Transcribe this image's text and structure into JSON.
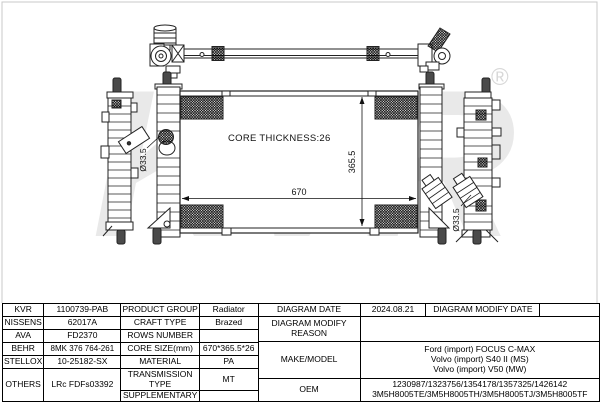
{
  "watermark": {
    "text": "KVR",
    "registered": "®",
    "color": "#e9e9e9"
  },
  "diagram": {
    "core_thickness_label": "CORE THICKNESS:26",
    "dim_width": "670",
    "dim_height": "365.5",
    "pipe_diameter_left": "Ø33.5",
    "pipe_diameter_right": "Ø33.5"
  },
  "table": {
    "brands": [
      {
        "brand": "KVR",
        "number": "1100739-PAB"
      },
      {
        "brand": "NISSENS",
        "number": "62017A"
      },
      {
        "brand": "AVA",
        "number": "FD2370"
      },
      {
        "brand": "BEHR",
        "number": "8MK 376 764-261"
      },
      {
        "brand": "STELLOX",
        "number": "10-25182-SX"
      },
      {
        "brand": "OTHERS",
        "number": "LRc FDFs03392"
      }
    ],
    "specs": [
      {
        "label": "PRODUCT GROUP",
        "value": "Radiator"
      },
      {
        "label": "CRAFT TYPE",
        "value": "Brazed"
      },
      {
        "label": "ROWS NUMBER",
        "value": ""
      },
      {
        "label": "CORE SIZE(mm)",
        "value": "670*365.5*26"
      },
      {
        "label": "MATERIAL",
        "value": "PA"
      },
      {
        "label": "TRANSMISSION TYPE",
        "value": "MT"
      },
      {
        "label": "SUPPLEMENTARY",
        "value": ""
      }
    ],
    "info": {
      "diagram_date_label": "DIAGRAM DATE",
      "diagram_date": "2024.08.21",
      "diagram_modify_date_label": "DIAGRAM MODIFY DATE",
      "diagram_modify_date": "",
      "diagram_modify_reason_label": "DIAGRAM MODIFY REASON",
      "diagram_modify_reason": "",
      "make_model_label": "MAKE/MODEL",
      "make_model": [
        "Ford (import) FOCUS C-MAX",
        "Volvo (import) S40 II (MS)",
        "Volvo (import) V50 (MW)"
      ],
      "oem_label": "OEM",
      "oem": [
        "1230987/1323756/1354178/1357325/1426142",
        "3M5H8005TE/3M5H8005TH/3M5H8005TJ/3M5H8005TF"
      ]
    }
  }
}
